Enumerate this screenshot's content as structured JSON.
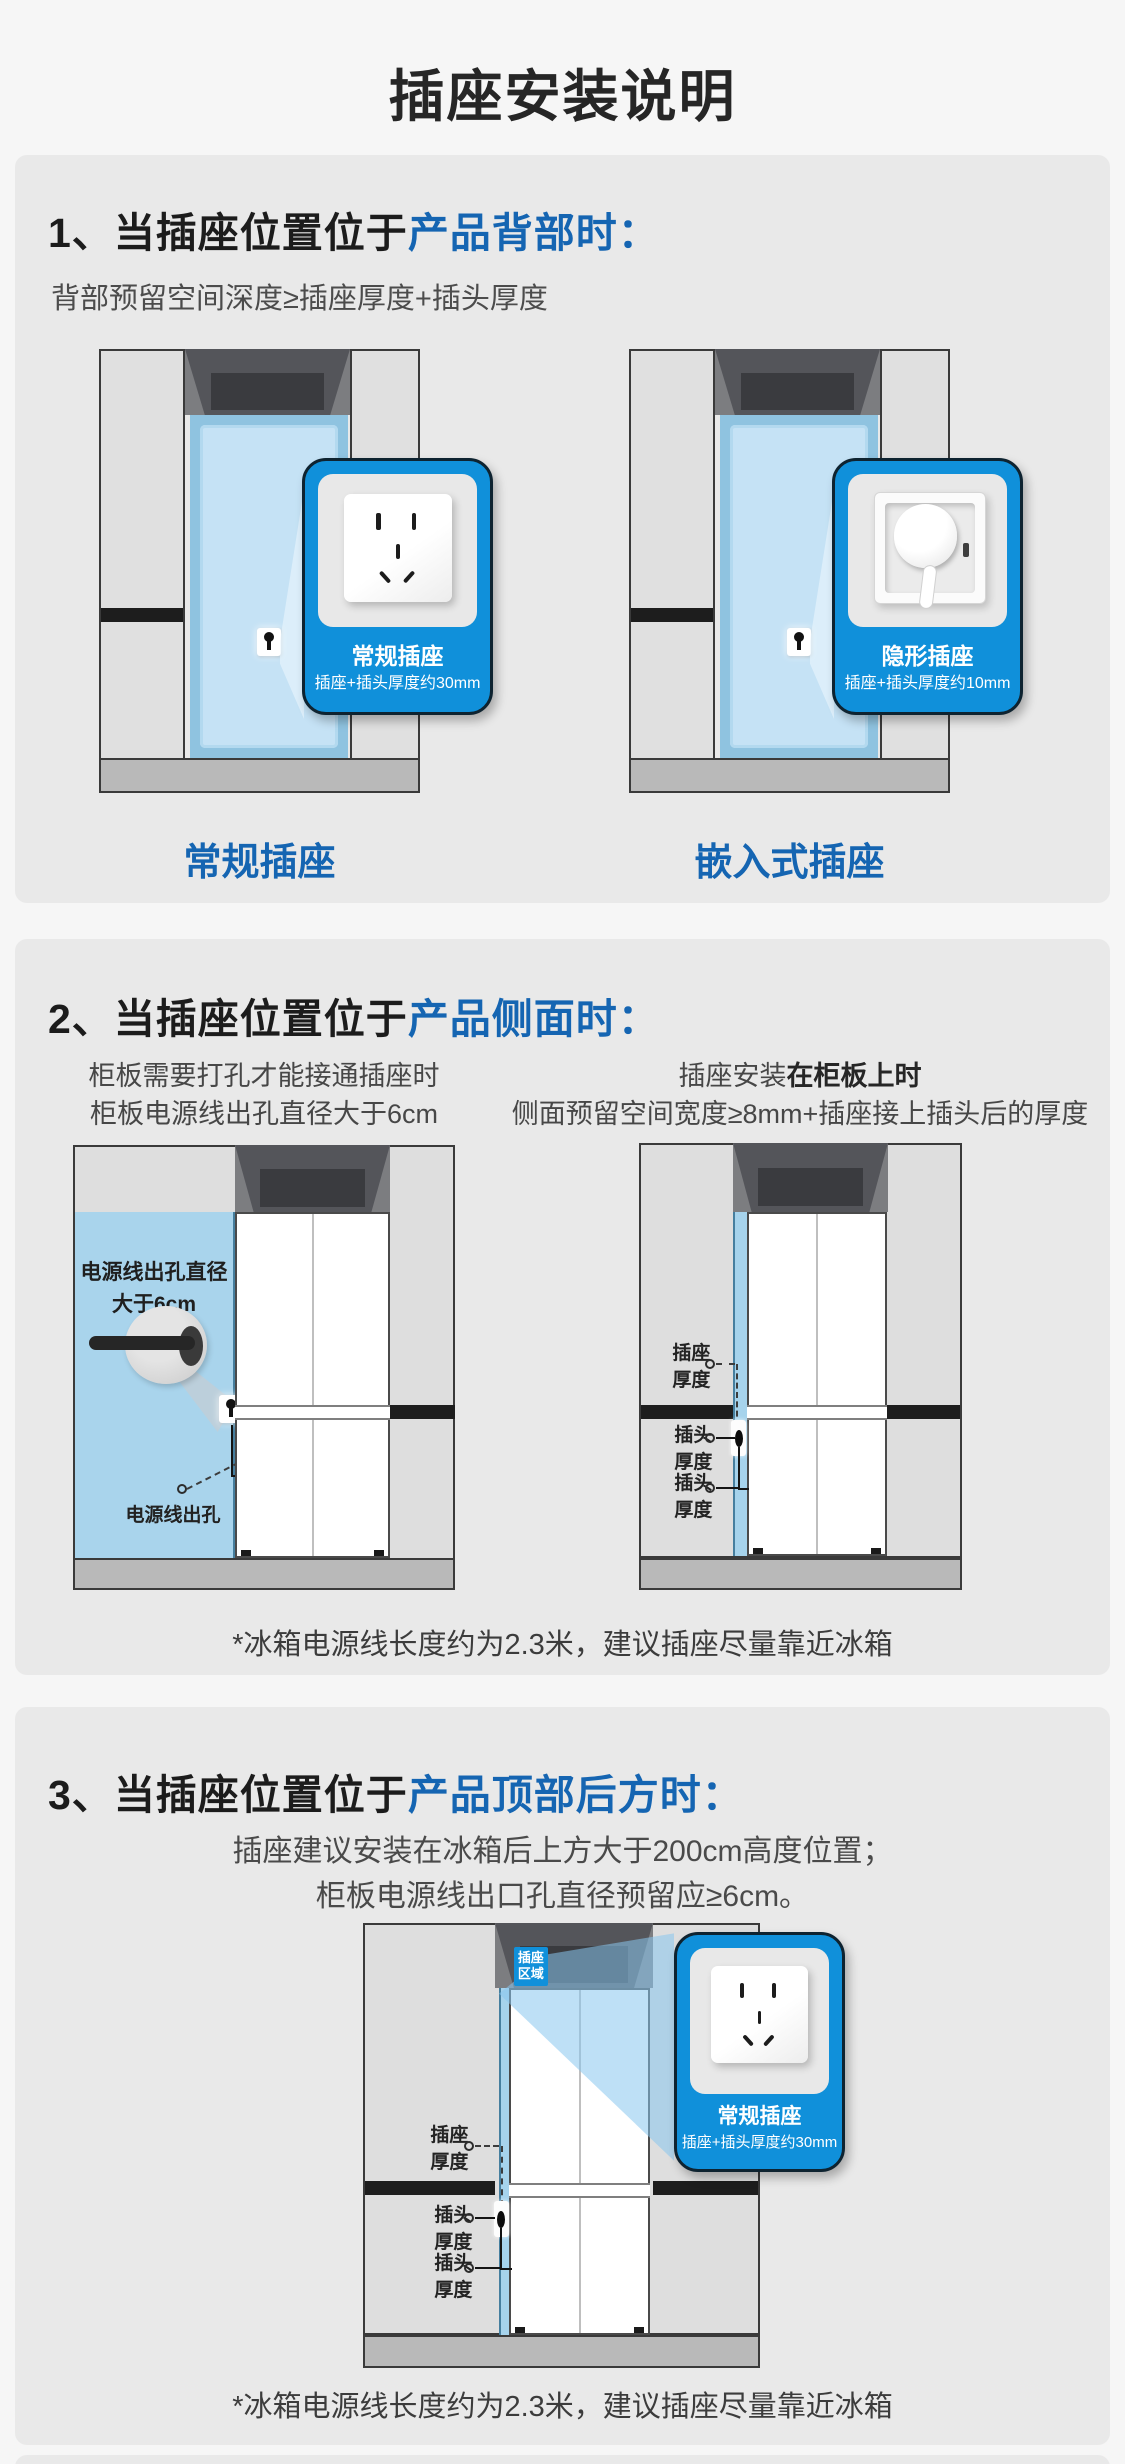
{
  "title": "插座安装说明",
  "colors": {
    "accent_blue": "#1565b2",
    "callout_blue": "#1090da",
    "panel_blue": "#b5dcf2",
    "card_bg": "#e9e9e9"
  },
  "s1": {
    "num": "1、",
    "head_pre": "当插座位置位于",
    "head_hi": "产品背部时：",
    "subtitle": "背部预留空间深度≥插座厚度+插头厚度",
    "a": {
      "callout_title": "常规插座",
      "callout_sub": "插座+插头厚度约30mm",
      "caption": "常规插座"
    },
    "b": {
      "callout_title": "隐形插座",
      "callout_sub": "插座+插头厚度约10mm",
      "caption": "嵌入式插座"
    }
  },
  "s2": {
    "num": "2、",
    "head_pre": "当插座位置位于",
    "head_hi": "产品侧面时：",
    "left": {
      "intro1": "柜板需要打孔才能接通插座时",
      "intro2": "柜板电源线出孔直径大于6cm",
      "panel_label1": "电源线出孔直径",
      "panel_label2": "大于6cm",
      "exit_label": "电源线出孔"
    },
    "right": {
      "intro1_pre": "插座安装",
      "intro1_bold": "在柜板上时",
      "intro2": "侧面预留空间宽度≥8mm+插座接上插头后的厚度",
      "socket_thickness": "插座厚度",
      "plug_thickness": "插头厚度"
    },
    "note": "*冰箱电源线长度约为2.3米，建议插座尽量靠近冰箱"
  },
  "s3": {
    "num": "3、",
    "head_pre": "当插座位置位于",
    "head_hi": "产品顶部后方时：",
    "intro1": "插座建议安装在冰箱后上方大于200cm高度位置；",
    "intro2": "柜板电源线出口孔直径预留应≥6cm。",
    "badge": "插座区域",
    "socket_thickness": "插座厚度",
    "plug_thickness": "插头厚度",
    "callout_title": "常规插座",
    "callout_sub": "插座+插头厚度约30mm",
    "note": "*冰箱电源线长度约为2.3米，建议插座尽量靠近冰箱"
  }
}
